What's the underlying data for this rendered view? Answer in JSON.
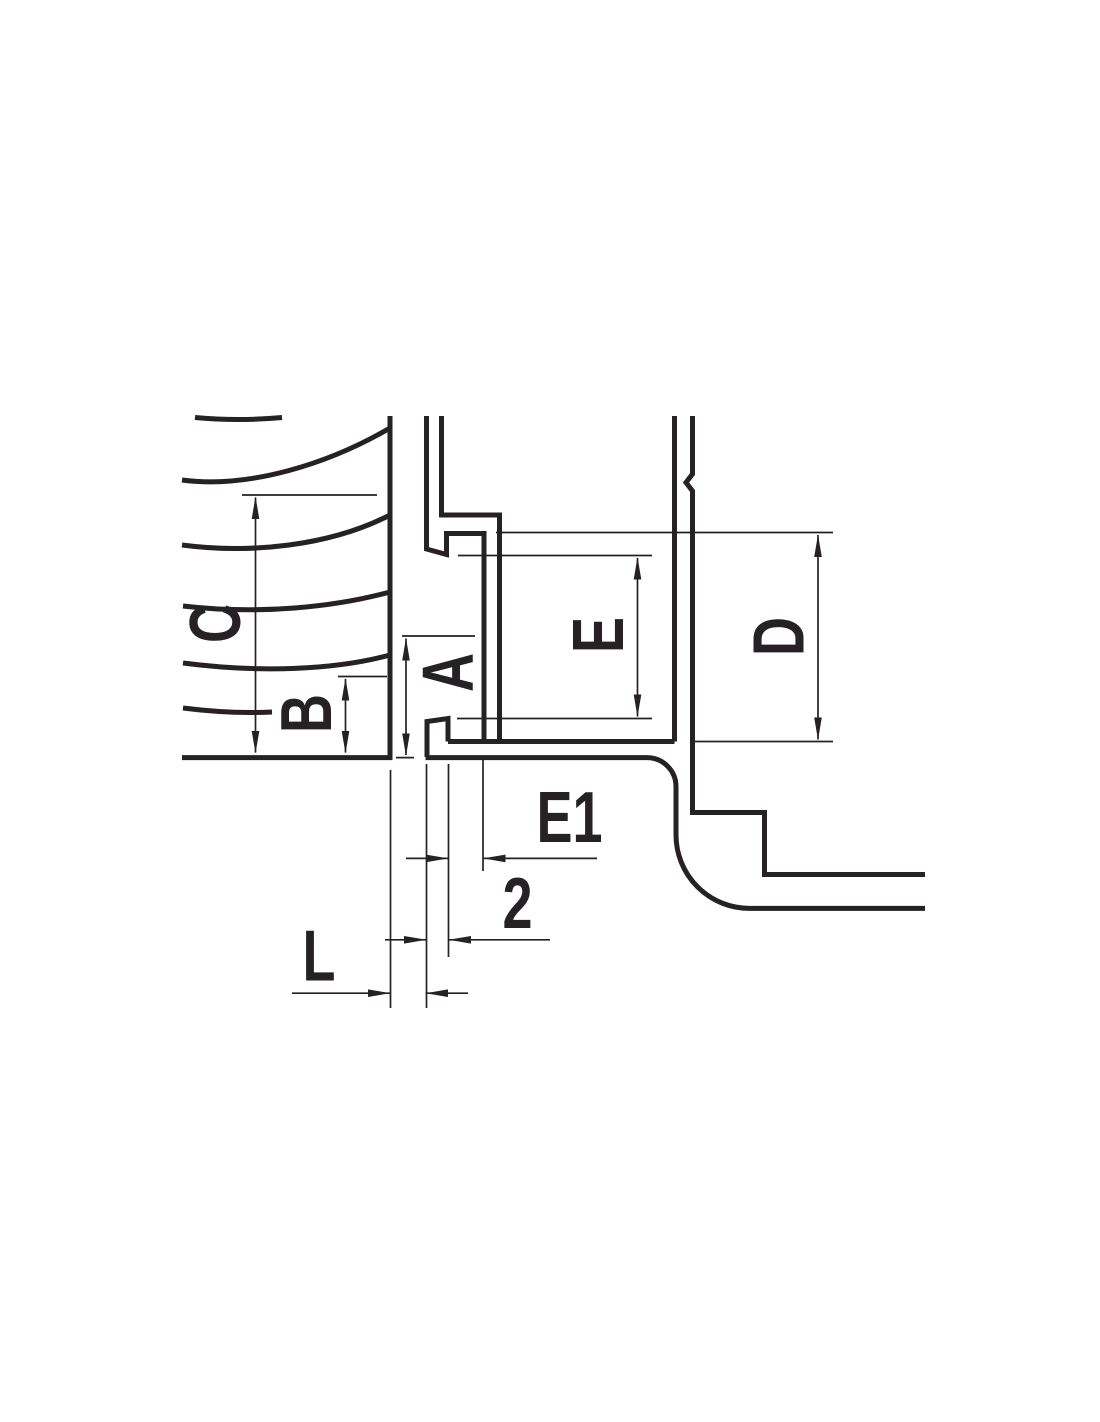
{
  "drawing": {
    "kind": "technical-cross-section",
    "background_color": "#ffffff",
    "line_color": "#262124",
    "labels": {
      "C": "C",
      "B": "B",
      "A": "A",
      "E": "E",
      "D": "D",
      "E1": "E1",
      "two": "2",
      "L": "L"
    }
  }
}
